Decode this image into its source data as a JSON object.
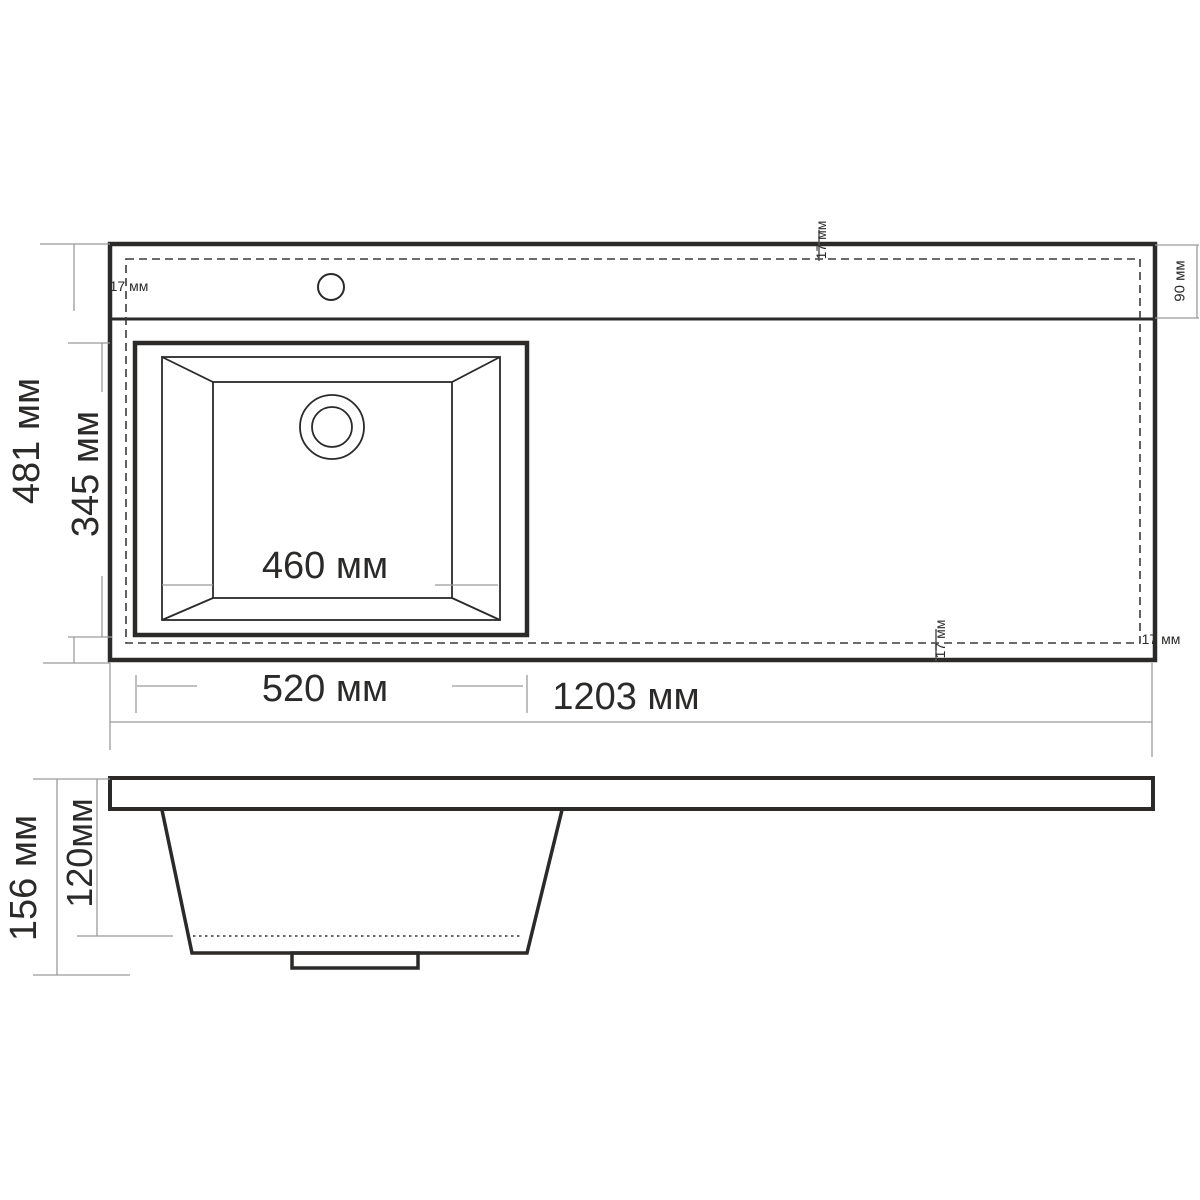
{
  "drawing": {
    "title": "washbasin-technical-drawing",
    "ink_color": "#2b2a29",
    "thin_line_color": "#9a9a9a",
    "top_view": {
      "total_width": "1203 мм",
      "total_height": "481 мм",
      "bowl_outer_width": "520 мм",
      "bowl_inner_width": "460 мм",
      "bowl_inner_height": "345 мм",
      "faucet_deck_depth": "90 мм",
      "edge_margin_top_left": "17 мм",
      "edge_margin_top": "17 мм",
      "edge_margin_bottom": "17 мм",
      "edge_margin_bottom_right": "17 мм"
    },
    "side_view": {
      "total_depth": "156 мм",
      "bowl_depth": "120мм"
    }
  }
}
